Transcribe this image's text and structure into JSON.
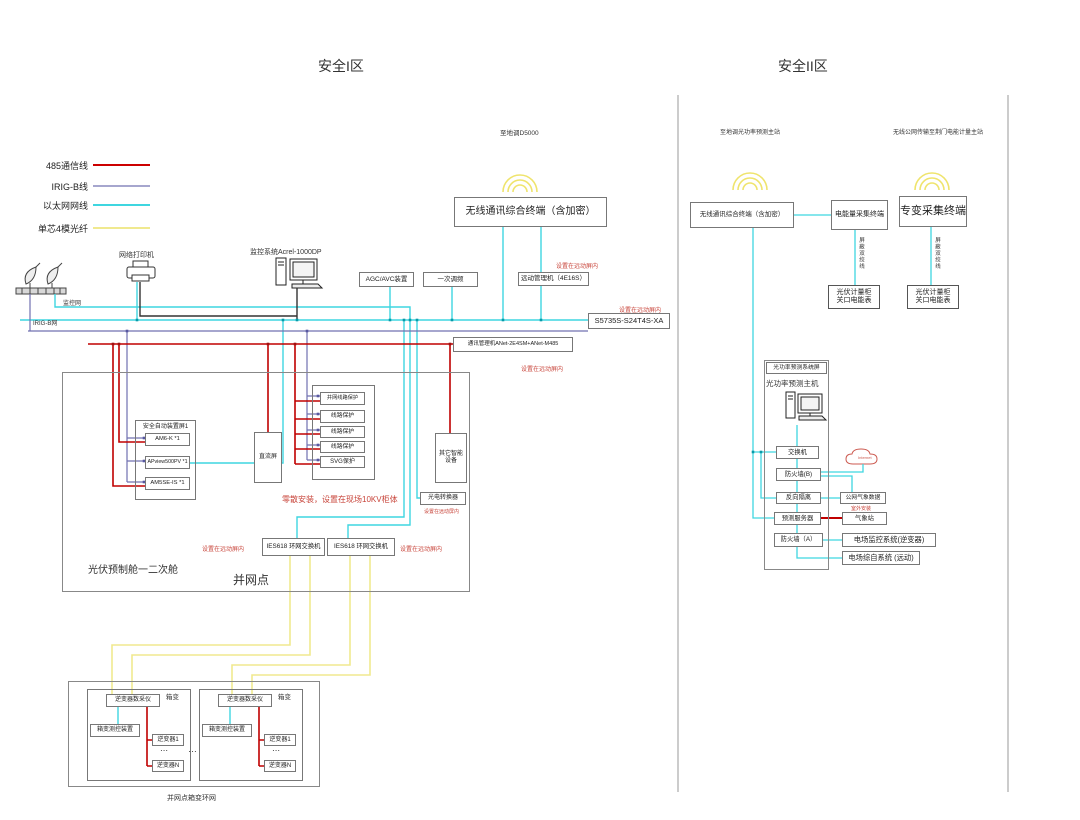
{
  "legend": {
    "items": [
      {
        "label": "485通信线",
        "color": "#cc0000"
      },
      {
        "label": "IRIG-B线",
        "color": "#7070b0"
      },
      {
        "label": "以太网网线",
        "color": "#3fd6e0"
      },
      {
        "label": "单芯4模光纤",
        "color": "#f0e98f"
      }
    ]
  },
  "zone1": {
    "title": "安全I区",
    "top_label": "至地调D5000",
    "wireless_terminal": "无线通讯综合终端（含加密）",
    "printer": "网络打印机",
    "scada": "监控系统Acrel-1000DP",
    "agc": "AGC/AVC装置",
    "freq": "一次调频",
    "rtu": "远动管理机（4E16S）",
    "core_switch": "S5735S-S24T4S-XA",
    "comm_manager": "通讯管理机ANet-2E4SM+ANet-M485",
    "note_remote": "设置在远动屏内",
    "monitor_net": "监控网",
    "irig_net": "IRIG-B网",
    "auto_panel": {
      "title": "安全自动装置屏1",
      "items": [
        "AM6-K *1",
        "APview500PV *1",
        "AM5SE-IS *1"
      ]
    },
    "dc_panel": "直流屏",
    "protection": {
      "items": [
        "并网线路保护",
        "线路保护",
        "线路保护",
        "线路保护",
        "SVG保护"
      ]
    },
    "other_devices": "其它智能设备",
    "photo_converter": "光电转换器",
    "scatter_note": "零散安装，设置在现场10KV柜体",
    "ring_switch": "IES618 环网交换机",
    "cabin_label": "光伏预制舱一二次舱",
    "grid_point": "并网点",
    "transformers": [
      {
        "label": "箱变",
        "daq": "逆变器数采仪",
        "controller": "箱变测控装置",
        "inverter_first": "逆变器1",
        "dots": "⋯",
        "inverter_last": "逆变器N"
      },
      {
        "label": "箱变",
        "daq": "逆变器数采仪",
        "controller": "箱变测控装置",
        "inverter_first": "逆变器1",
        "dots": "⋯",
        "inverter_last": "逆变器N"
      }
    ],
    "between_dots": "…",
    "bottom_label": "并网点箱变环网"
  },
  "zone2": {
    "title": "安全II区",
    "left_top_label": "至地调光功率预测主站",
    "right_top_label": "无线公网传输至荆门电能计量主站",
    "wireless_terminal": "无线通讯综合终端（含加密）",
    "energy_terminal": "电能量采集终端",
    "transformer_terminal": "专变采集终端",
    "twisted_pair": "屏蔽双绞线",
    "meter_cabinets": [
      {
        "line1": "光伏计量柜",
        "line2": "关口电能表"
      },
      {
        "line1": "光伏计量柜",
        "line2": "关口电能表"
      }
    ],
    "prediction_panel": "光功率预测系统屏",
    "prediction_host": "光功率预测主机",
    "switch": "交换机",
    "firewall_b": "防火墙(B)",
    "reverse_isolation": "反向隔离",
    "weather_data": "公网气象数据",
    "outdoor_note": "室外安装",
    "prediction_server": "预测服务器",
    "weather_station": "气象站",
    "firewall_a": "防火墙（A）",
    "field_monitor": "电场监控系统(逆变器)",
    "field_integrated": "电场综自系统 (远动)",
    "internet": "Internet"
  }
}
